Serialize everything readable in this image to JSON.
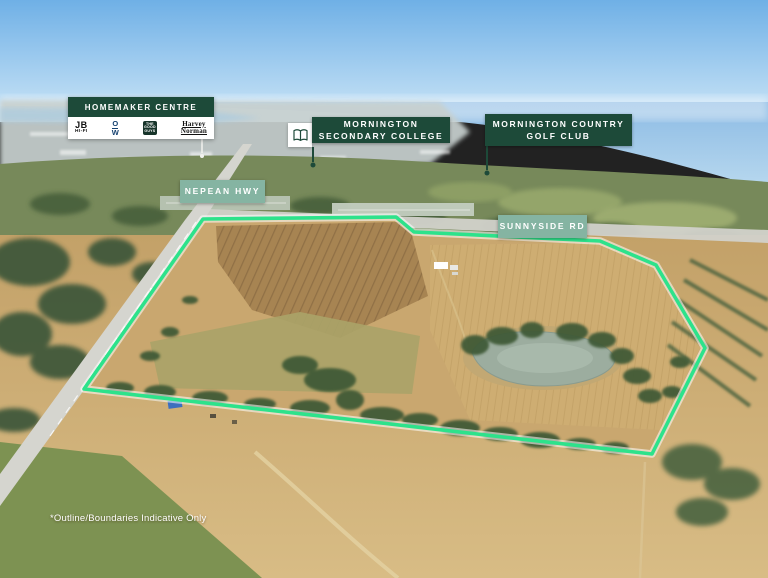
{
  "labels": {
    "homemaker_centre": {
      "title": "HOMEMAKER CENTRE"
    },
    "secondary_college": {
      "line1": "MORNINGTON",
      "line2": "SECONDARY COLLEGE"
    },
    "golf_club": {
      "line1": "MORNINGTON COUNTRY",
      "line2": "GOLF CLUB"
    },
    "nepean_hwy": {
      "text": "NEPEAN HWY"
    },
    "sunnyside_rd": {
      "text": "SUNNYSIDE RD"
    }
  },
  "logos": {
    "jb_hifi": {
      "line1": "JB",
      "line2": "HI-FI"
    },
    "officeworks": {
      "line1": "O",
      "line2": "W"
    },
    "good_guys": {
      "line1": "THE",
      "line2": "GOOD",
      "line3": "GUYS"
    },
    "harvey_norman": {
      "line1": "Harvey",
      "line2": "Norman"
    }
  },
  "disclaimer": "*Outline/Boundaries Indicative Only",
  "colors": {
    "label_dark_green": "#1d4a39",
    "label_sage_green": "#85b4a2",
    "boundary_outline_green": "#2de28b",
    "label_text": "#ffffff"
  }
}
